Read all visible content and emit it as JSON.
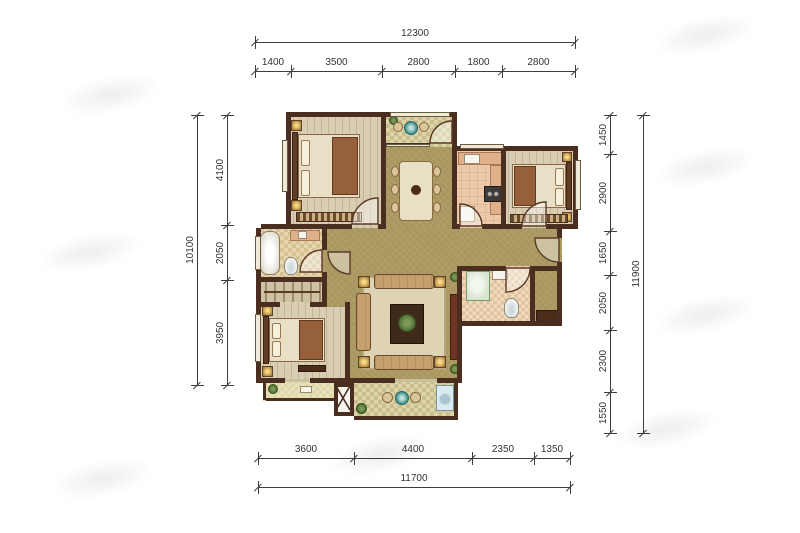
{
  "dimensions": {
    "top": {
      "total": "12300",
      "segments": [
        "1400",
        "3500",
        "2800",
        "1800",
        "2800"
      ]
    },
    "left": {
      "total": "10100",
      "segments": [
        "4100",
        "2050",
        "3950"
      ]
    },
    "right": {
      "total": "11900",
      "segments": [
        "1450",
        "2900",
        "1650",
        "2050",
        "2300",
        "1550"
      ]
    },
    "bottom": {
      "total": "11700",
      "segments": [
        "3600",
        "4400",
        "2350",
        "1350"
      ]
    }
  },
  "colors": {
    "wall": "#4a2e1f",
    "floor_main": "#ab9a62",
    "floor_bedroom": "#d9cdb3",
    "floor_kitchen": "#ecc9a9",
    "floor_bath": "#dcc79e",
    "floor_balcony": "#cfc493",
    "dim_line": "#3d3d3d",
    "gold_accent": "#e8c06a",
    "plant_green": "#4f7038",
    "background": "#ffffff"
  }
}
